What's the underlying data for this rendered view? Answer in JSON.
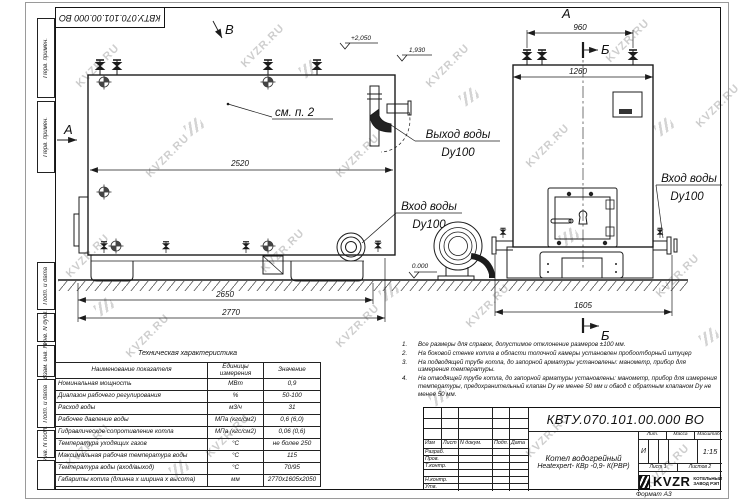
{
  "watermark": {
    "text": "KVZR.RU"
  },
  "stamp": {
    "doc_number_top": "КВТУ.070.101.00.000  ВО"
  },
  "margin_cells": [
    "Перв. примен.",
    "Перв. примен.",
    "Подп. и дата",
    "Инв. N дубл.",
    "Взам. инв. N",
    "Подп. и дата",
    "Инв. N подл."
  ],
  "drawing": {
    "views": {
      "a_side": "А",
      "v_top": "В",
      "a_front": "А",
      "b_top": "Б",
      "b_bottom": "Б"
    },
    "dims": {
      "side_width": "2520",
      "base_len": "2650",
      "total_len": "2770",
      "valve_span": "960",
      "front_width": "1260",
      "front_len": "1605"
    },
    "elev": {
      "top": "+2,050",
      "outlet": "1,930",
      "ground": "0.000"
    },
    "labels": {
      "see_note": "см. п. 2",
      "water_out": "Выход воды",
      "water_out_dn": "Dy100",
      "water_in_left": "Вход воды",
      "water_in_left_dn": "Dy100",
      "water_in_right": "Вход воды",
      "water_in_right_dn": "Dy100"
    }
  },
  "tech": {
    "title": "Техническая характеристика",
    "col_name": "Наименование показателя",
    "col_units": "Единицы измерения",
    "col_value": "Значение",
    "rows": [
      [
        "Номинальная мощность",
        "МВт",
        "0,9"
      ],
      [
        "Диапазон рабочего регулирования",
        "%",
        "50-100"
      ],
      [
        "Расход воды",
        "м3/ч",
        "31"
      ],
      [
        "Рабочее давление воды",
        "МПа (кгс/см2)",
        "0,6 (6,0)"
      ],
      [
        "Гидравлическое сопротивление котла",
        "МПа (кгс/см2)",
        "0,06 (0,6)"
      ],
      [
        "Температура уходящих газов",
        "°С",
        "не более 250"
      ],
      [
        "Максимальная рабочая температура воды",
        "°С",
        "115"
      ],
      [
        "Температура воды (вход/выход)",
        "°С",
        "70/95"
      ],
      [
        "Габариты котла (длинна х ширина х высота)",
        "мм",
        "2770х1605х2050"
      ]
    ]
  },
  "notes": [
    {
      "num": "1.",
      "text": "Все размеры для справок, допустимое отклонение размеров ±100 мм."
    },
    {
      "num": "2.",
      "text": "На боковой стенке котла в области топочной камеры установлен пробоотборный штуцер"
    },
    {
      "num": "3.",
      "text": "На  подводящей трубе котла, до запорной арматуры установлены: манометр, прибор для измерения температуры."
    },
    {
      "num": "4.",
      "text": "На отводящей трубе котла, до запорной арматуры установлены: манометр, прибор для измерения температуры, предохранительный клапан Dу не менее 50 мм и обвод с обратным клапаном Dу не менее 50 мм."
    }
  ],
  "tb": {
    "doc_number": "КВТУ.070.101.00.000  ВО",
    "name1": "Котел водогрейный",
    "name2": "Heatexpert- КВр -0,9- К(РВР)",
    "h_izm": "Изм",
    "h_list": "Лист",
    "h_doc": "N докум.",
    "h_podp": "Подп.",
    "h_data": "Дата",
    "r1": "Разраб.",
    "r2": "Пров.",
    "r3": "Т.контр.",
    "r4": "Н.контр.",
    "r5": "Утв.",
    "lit": "Лит.",
    "mass": "Масса",
    "scale": "Масштаб",
    "lit_v": "И",
    "scale_v": "1:15",
    "sheet": "Лист",
    "sheet_v": "1",
    "sheets": "Листов",
    "sheets_v": "2",
    "brand": "KVZR",
    "brand1": "КОТЕЛЬНЫЙ",
    "brand2": "ЗАВОД РЭП",
    "format": "Формат  А3"
  }
}
